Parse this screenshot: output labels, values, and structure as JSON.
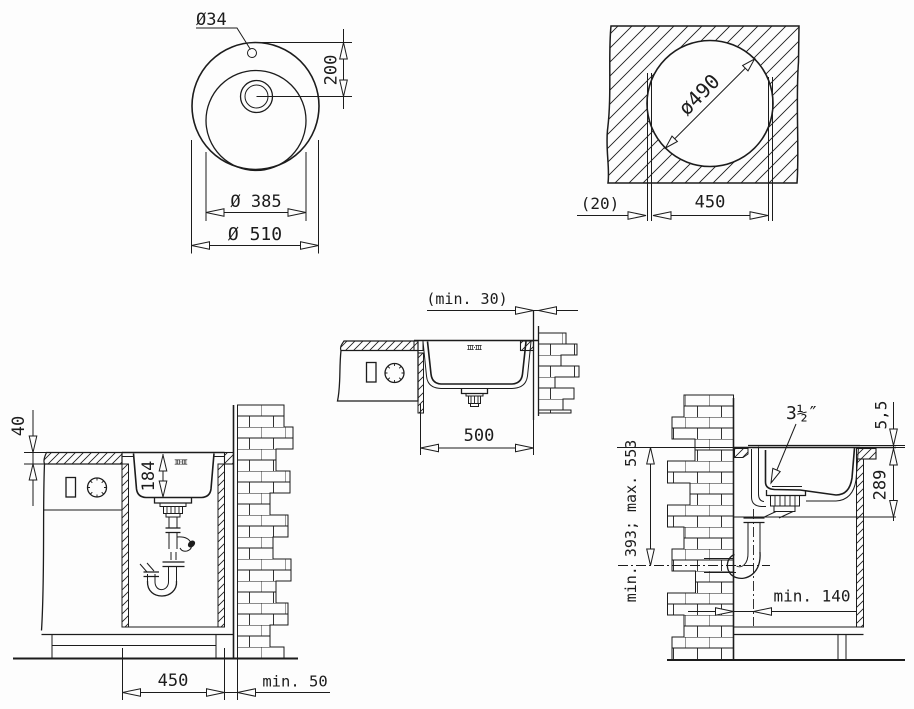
{
  "title": "Kitchen sink installation technical drawing",
  "colors": {
    "background": "#fdfdfd",
    "ink": "#1c1c1c"
  },
  "views": {
    "plan": {
      "name": "Round sink top view",
      "labels": {
        "tap_hole": "Ø34",
        "rim_to_drain": "200",
        "bowl_diameter": "Ø 385",
        "overall_diameter": "Ø 510"
      }
    },
    "cutout": {
      "name": "Worktop cut-out view",
      "labels": {
        "sink_diameter": "ø490",
        "edge_offset": "(20)",
        "cutout_width": "450"
      }
    },
    "front_section": {
      "name": "Front section at worktop",
      "labels": {
        "wall_clearance": "(min. 30)",
        "unit_width": "500",
        "overflow_mark": "III·III"
      }
    },
    "side_section": {
      "name": "Cabinet section with trap",
      "labels": {
        "worktop_thickness": "40",
        "bowl_depth": "184",
        "cabinet_width": "450",
        "wall_gap": "min. 50",
        "overflow_mark": "III·III"
      }
    },
    "drain_section": {
      "name": "Drain height section",
      "labels": {
        "waste_size": "3½″",
        "rim_height": "5,5",
        "under_top_depth": "289",
        "drain_height": "min. 393; max. 553",
        "trap_wall_distance": "min. 140"
      }
    }
  }
}
